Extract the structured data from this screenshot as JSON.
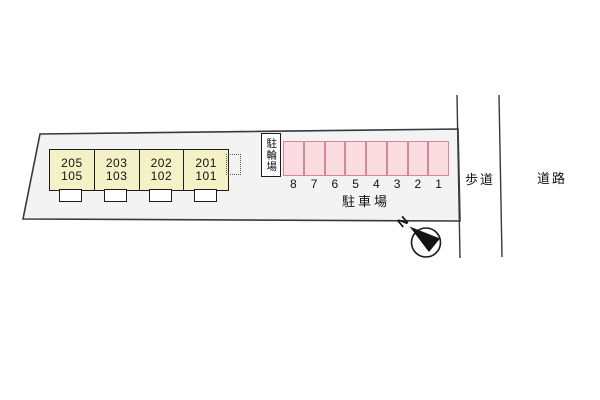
{
  "plan": {
    "building": {
      "units": [
        {
          "upper": "205",
          "lower": "105"
        },
        {
          "upper": "203",
          "lower": "103"
        },
        {
          "upper": "202",
          "lower": "102"
        },
        {
          "upper": "201",
          "lower": "101"
        }
      ]
    },
    "bicycle_parking": {
      "label": "駐輪場"
    },
    "parking": {
      "label": "駐車場",
      "space_numbers": [
        "8",
        "7",
        "6",
        "5",
        "4",
        "3",
        "2",
        "1"
      ]
    },
    "streets": {
      "sidewalk": "歩道",
      "road": "道路"
    },
    "compass": {
      "north_label": "N"
    },
    "colors": {
      "plot_fill": "#f3f3f3",
      "outline": "#3a3a3a",
      "building_fill": "#f5f1c6",
      "building_border": "#1c1c1c",
      "parking_fill": "#fadce1",
      "parking_border": "#d48894"
    }
  }
}
